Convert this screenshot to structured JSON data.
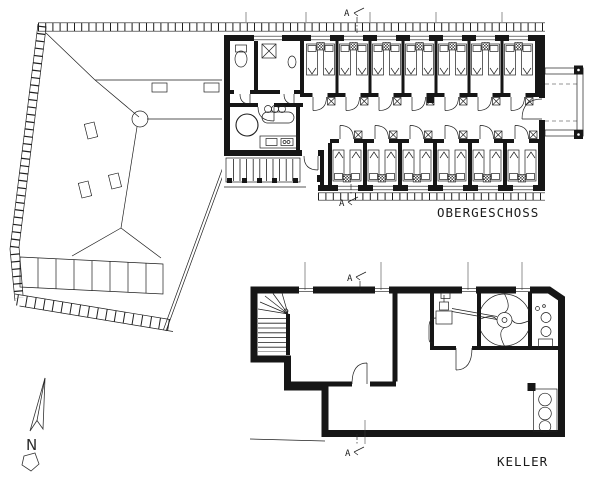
{
  "sheet": {
    "background": "#ffffff",
    "ink": "#1f1f1f",
    "type": "architectural floor plan drawing"
  },
  "plans": {
    "upper_floor": {
      "label": "OBERGESCHOSS",
      "rooms_top_row": 7,
      "rooms_bottom_row": 6
    },
    "basement": {
      "label": "KELLER"
    }
  },
  "compass": {
    "label": "N"
  },
  "section_marker": {
    "letter": "A"
  }
}
